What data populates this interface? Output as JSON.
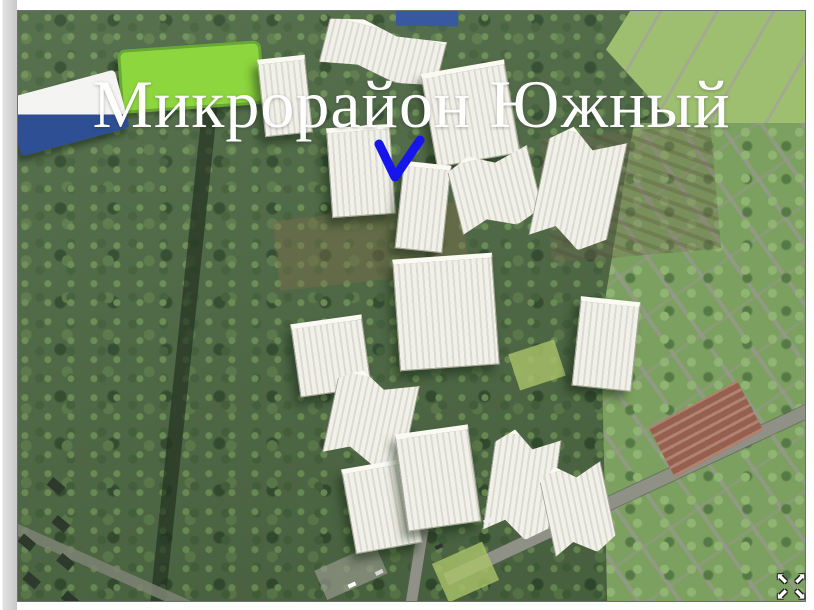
{
  "slide": {
    "title": "Микрорайон Южный"
  },
  "annotation": {
    "shape": "checkmark",
    "color": "#1515ec"
  },
  "controls": {
    "fullscreen_button": {
      "icon": "expand-arrows-icon",
      "glyphs": [
        "⬉",
        "⬈",
        "⬋",
        "⬊"
      ]
    }
  },
  "palette": {
    "title_text": "#ffffff",
    "annotation_blue": "#1515ec",
    "forest_base": "#4d6843",
    "forest_light": "#6c8f54",
    "field_green": "#8ed63e",
    "building_white": "#f2f1e9",
    "road_gray": "#8f9086",
    "suburb_green": "#7ca05f",
    "sporthall_blue": "#2e4f93",
    "plaza_red": "#96604e",
    "margin_gray": "#c8c8c8"
  }
}
